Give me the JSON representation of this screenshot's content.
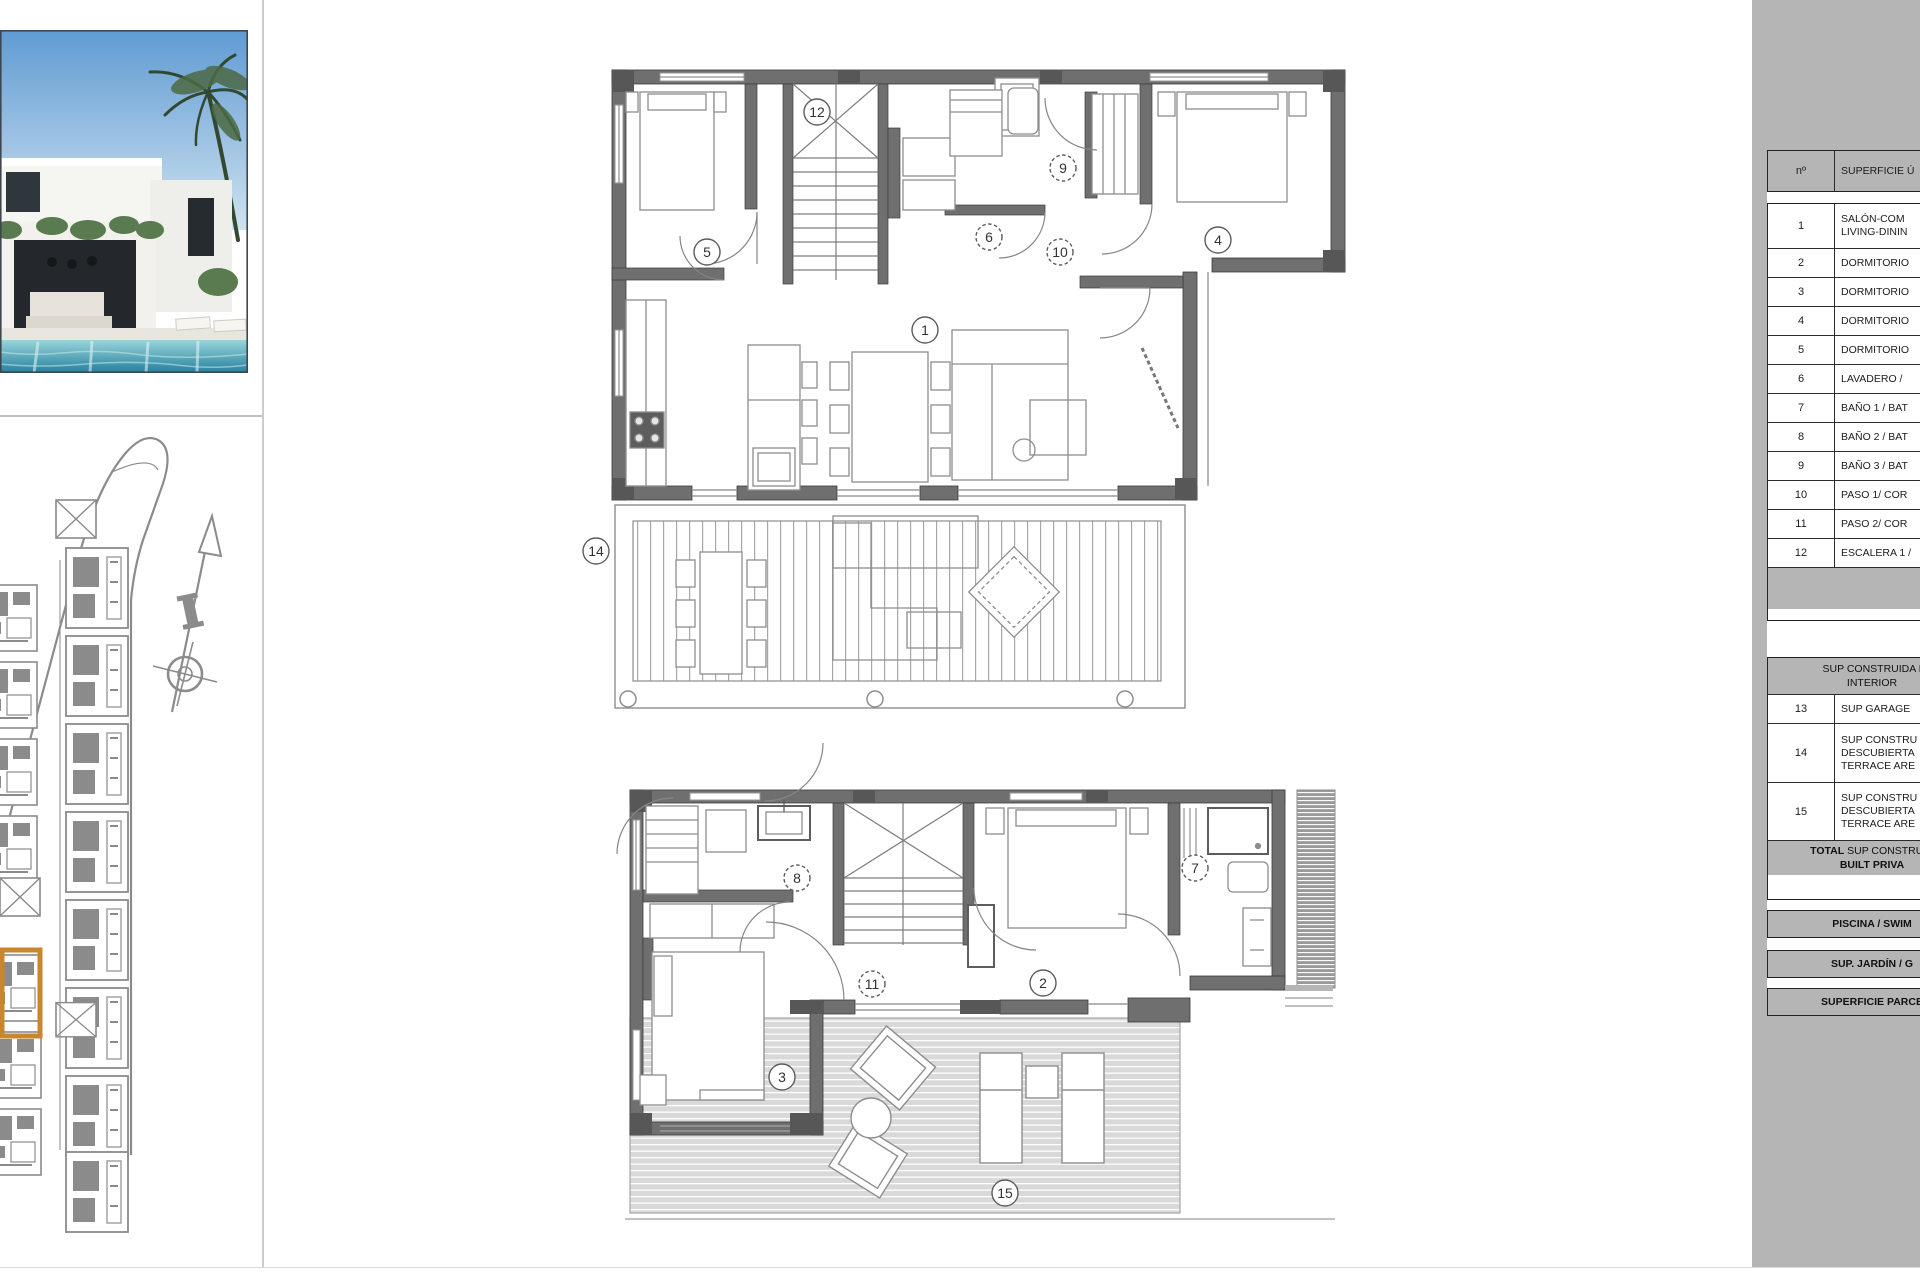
{
  "colors": {
    "panel_grey": "#b5b5b5",
    "wall_grey": "#6f6f6f",
    "pillar_grey": "#575757",
    "site_grey": "#8b8b8b",
    "deck_grey": "#d9d9d9",
    "highlight_orange": "#c8862e",
    "pool_blue": "#2e8ea8"
  },
  "surface_table": {
    "header": {
      "num": "nº",
      "desc": "SUPERFICIE Ú"
    },
    "rooms": [
      {
        "num": "1",
        "lines": [
          "SALÓN-COM",
          "LIVING-DININ"
        ]
      },
      {
        "num": "2",
        "lines": [
          "DORMITORIO"
        ]
      },
      {
        "num": "3",
        "lines": [
          "DORMITORIO"
        ]
      },
      {
        "num": "4",
        "lines": [
          "DORMITORIO"
        ]
      },
      {
        "num": "5",
        "lines": [
          "DORMITORIO"
        ]
      },
      {
        "num": "6",
        "lines": [
          "LAVADERO /"
        ]
      },
      {
        "num": "7",
        "lines": [
          "BAÑO 1 / BAT"
        ]
      },
      {
        "num": "8",
        "lines": [
          "BAÑO 2 / BAT"
        ]
      },
      {
        "num": "9",
        "lines": [
          "BAÑO 3 / BAT"
        ]
      },
      {
        "num": "10",
        "lines": [
          "PASO 1/ COR"
        ]
      },
      {
        "num": "11",
        "lines": [
          "PASO 2/ COR"
        ]
      },
      {
        "num": "12",
        "lines": [
          "ESCALERA 1 /"
        ]
      }
    ],
    "section2_header_lines": [
      "SUP CONSTRUIDA I",
      "INTERIOR"
    ],
    "extra_rows": [
      {
        "num": "13",
        "lines": [
          "SUP GARAGE"
        ]
      },
      {
        "num": "14",
        "lines": [
          "SUP CONSTRU",
          "DESCUBIERTA",
          "TERRACE ARE"
        ]
      },
      {
        "num": "15",
        "lines": [
          "SUP CONSTRU",
          "DESCUBIERTA",
          "TERRACE ARE"
        ]
      }
    ],
    "total": {
      "prefix": "TOTAL",
      "line1": " SUP CONSTRUID",
      "line2": "BUILT PRIVA"
    },
    "summary_bars": [
      "PISCINA / SWIM",
      "SUP. JARDÍN / G",
      "SUPERFICIE PARCE"
    ]
  },
  "floor_plans": {
    "upper": {
      "markers": [
        {
          "label": "12",
          "x": 817,
          "y": 112,
          "dashed": false
        },
        {
          "label": "9",
          "x": 1063,
          "y": 168,
          "dashed": true
        },
        {
          "label": "6",
          "x": 989,
          "y": 237,
          "dashed": true
        },
        {
          "label": "10",
          "x": 1060,
          "y": 252,
          "dashed": true
        },
        {
          "label": "5",
          "x": 707,
          "y": 252,
          "dashed": false
        },
        {
          "label": "4",
          "x": 1218,
          "y": 240,
          "dashed": false
        },
        {
          "label": "1",
          "x": 925,
          "y": 330,
          "dashed": false
        },
        {
          "label": "14",
          "x": 596,
          "y": 551,
          "dashed": false
        }
      ]
    },
    "lower": {
      "markers": [
        {
          "label": "8",
          "x": 797,
          "y": 878,
          "dashed": true
        },
        {
          "label": "7",
          "x": 1195,
          "y": 868,
          "dashed": true
        },
        {
          "label": "11",
          "x": 872,
          "y": 984,
          "dashed": true
        },
        {
          "label": "2",
          "x": 1043,
          "y": 983,
          "dashed": false
        },
        {
          "label": "3",
          "x": 782,
          "y": 1077,
          "dashed": false
        },
        {
          "label": "15",
          "x": 1005,
          "y": 1193,
          "dashed": false
        }
      ]
    }
  }
}
